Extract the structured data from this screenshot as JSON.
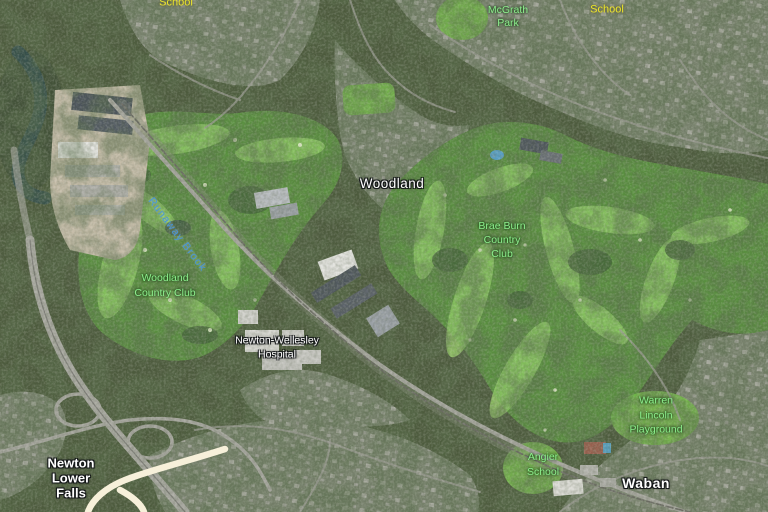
{
  "map": {
    "view_type": "satellite",
    "label_styles": {
      "white": {
        "color": "#ffffff",
        "halo": "-1px -1px 0 #15181a, 1px -1px 0 #15181a, -1px 1px 0 #15181a, 1px 1px 0 #15181a, 0 0 3px #000000"
      },
      "green": {
        "color": "#8dee8d",
        "halo": "0 0 3px rgba(0,45,0,0.85), 0 0 2px rgba(0,45,0,0.6)"
      },
      "yellow": {
        "color": "#ece42b",
        "halo": "0 0 3px rgba(70,60,0,0.75)"
      },
      "blue": {
        "color": "#4695db",
        "halo": "0 0 2px rgba(235,245,255,0.45)"
      }
    },
    "labels": [
      {
        "id": "school-northwest",
        "style": "yellow",
        "x": 176,
        "y": 3,
        "size": 11,
        "line_height": 13,
        "lines": [
          "School"
        ]
      },
      {
        "id": "richard-mcgrath-park",
        "style": "green",
        "x": 508,
        "y": 10,
        "size": 10.5,
        "line_height": 13.5,
        "lines": [
          "Richard",
          "McGrath",
          "Park"
        ]
      },
      {
        "id": "school-northeast",
        "style": "yellow",
        "x": 607,
        "y": 10,
        "size": 11,
        "line_height": 13,
        "lines": [
          "School"
        ]
      },
      {
        "id": "woodland",
        "style": "white",
        "x": 392,
        "y": 184,
        "size": 13.5,
        "line_height": 16,
        "letter_spacing": 0.5,
        "lines": [
          "Woodland"
        ]
      },
      {
        "id": "brae-burn-country-club",
        "style": "green",
        "x": 502,
        "y": 240,
        "size": 10.5,
        "line_height": 14,
        "lines": [
          "Brae Burn",
          "Country",
          "Club"
        ]
      },
      {
        "id": "runaway-brook",
        "style": "blue",
        "x": 177,
        "y": 235,
        "size": 10.5,
        "line_height": 13,
        "rotate": 53,
        "letter_spacing": 1.2,
        "lines": [
          "Runaway Brook"
        ]
      },
      {
        "id": "woodland-country-club",
        "style": "green",
        "x": 165,
        "y": 286,
        "size": 10.5,
        "line_height": 15,
        "lines": [
          "Woodland",
          "Country Club"
        ]
      },
      {
        "id": "newton-wellesley-hospital",
        "style": "white",
        "x": 277,
        "y": 348,
        "size": 10.5,
        "line_height": 13.5,
        "lines": [
          "Newton-Wellesley",
          "Hospital"
        ]
      },
      {
        "id": "warren-lincoln-playground",
        "style": "green",
        "x": 656,
        "y": 415,
        "size": 10.5,
        "line_height": 14.5,
        "lines": [
          "Warren",
          "Lincoln",
          "Playground"
        ]
      },
      {
        "id": "angier-school",
        "style": "green",
        "x": 543,
        "y": 465,
        "size": 10.5,
        "line_height": 15,
        "lines": [
          "Angier",
          "School"
        ]
      },
      {
        "id": "waban",
        "style": "white",
        "x": 646,
        "y": 483,
        "size": 14,
        "bold": true,
        "line_height": 16,
        "letter_spacing": 0.5,
        "lines": [
          "Waban"
        ]
      },
      {
        "id": "newton-lower-falls",
        "style": "white",
        "x": 71,
        "y": 478,
        "size": 13,
        "bold": true,
        "line_height": 15,
        "lines": [
          "Newton",
          "Lower",
          "Falls"
        ]
      }
    ]
  }
}
